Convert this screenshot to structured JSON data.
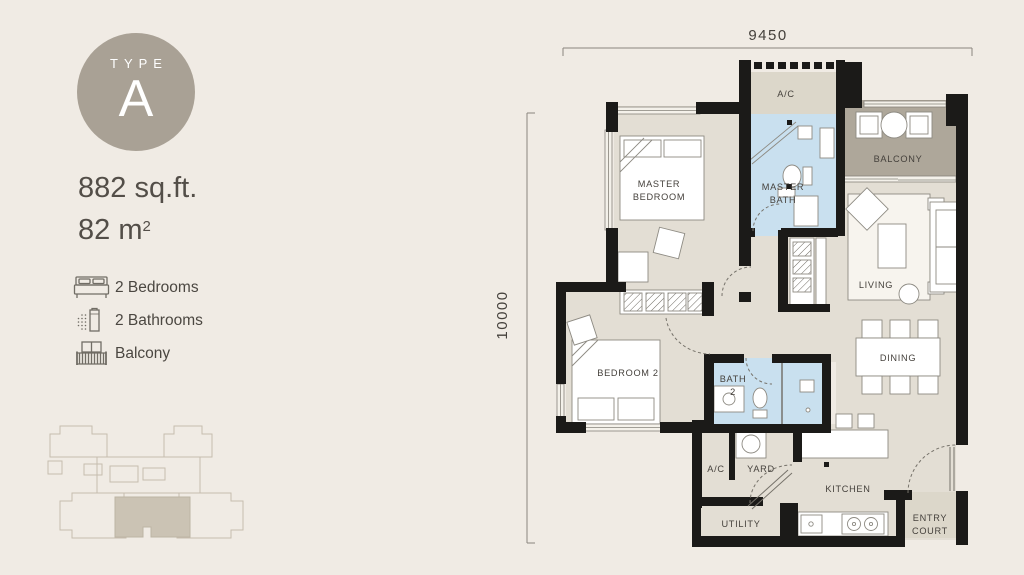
{
  "colors": {
    "background": "#F0EBE4",
    "badge": "#A9A195",
    "text_dark": "#4B4741",
    "wall_black": "#1B1A18",
    "floor": "#E3DED4",
    "floor_service": "#DCD7CA",
    "balcony_floor": "#AEA79A",
    "bath_blue": "#C9E0EF",
    "keyplan_line": "#C6BDAE",
    "keyplan_highlight": "#CBC3B4"
  },
  "panel": {
    "badge_label": "TYPE",
    "badge_letter": "A",
    "area_sqft": "882 sq.ft.",
    "area_m2_value": "82 m",
    "area_m2_sup": "2",
    "features": [
      {
        "icon": "bed-icon",
        "label": "2 Bedrooms"
      },
      {
        "icon": "shower-icon",
        "label": "2 Bathrooms"
      },
      {
        "icon": "balcony-icon",
        "label": "Balcony"
      }
    ]
  },
  "plan": {
    "dimensions": {
      "top": "9450",
      "left": "10000"
    },
    "labels": {
      "master_bedroom_1": "MASTER",
      "master_bedroom_2": "BEDROOM",
      "master_bath_1": "MASTER",
      "master_bath_2": "BATH",
      "ac_top": "A/C",
      "balcony": "BALCONY",
      "living": "LIVING",
      "dining": "DINING",
      "bedroom_2": "BEDROOM 2",
      "bath_2_1": "BATH",
      "bath_2_2": "2",
      "ac_bottom": "A/C",
      "yard": "YARD",
      "utility": "UTILITY",
      "kitchen": "KITCHEN",
      "entry_court_1": "ENTRY",
      "entry_court_2": "COURT"
    }
  }
}
